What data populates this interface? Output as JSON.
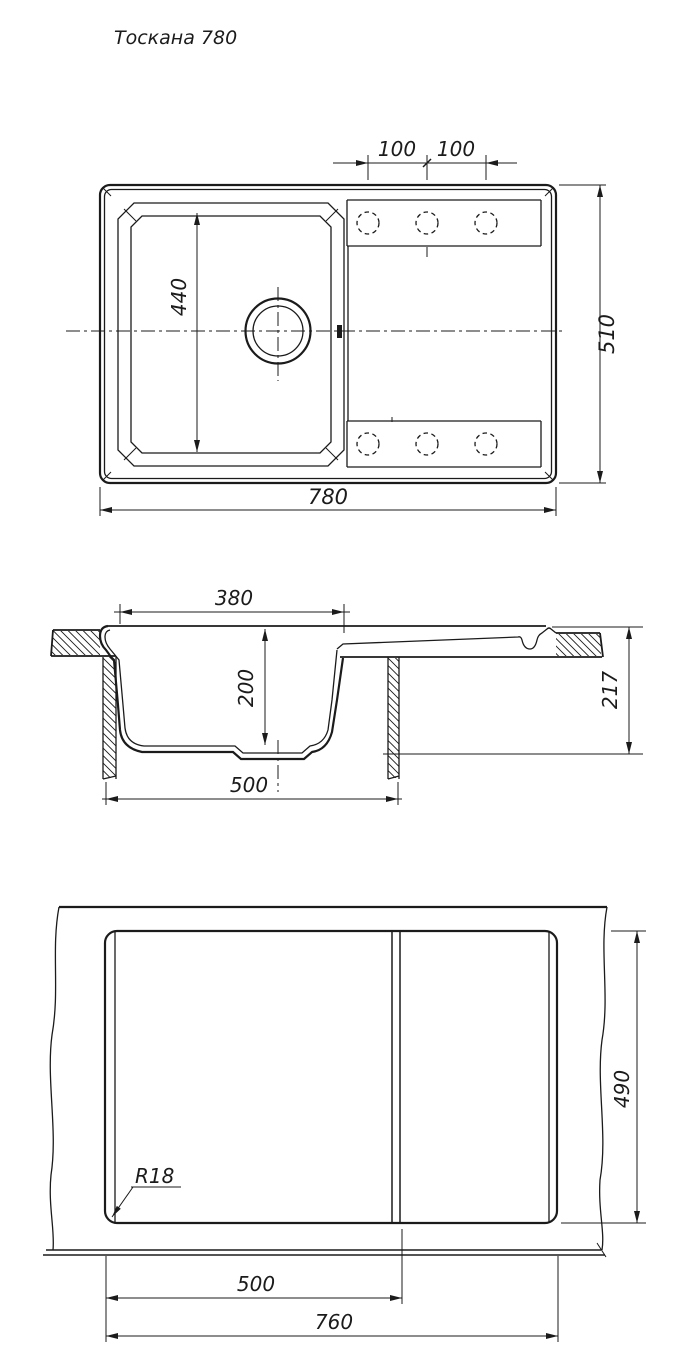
{
  "title": "Тоскана 780",
  "colors": {
    "line": "#1b1b1b",
    "background": "#ffffff"
  },
  "top_view": {
    "dim_hole_spacing_left": "100",
    "dim_hole_spacing_right": "100",
    "dim_bowl_length": "440",
    "dim_overall_width": "780",
    "dim_overall_depth": "510"
  },
  "section_view": {
    "dim_bowl_opening": "380",
    "dim_bowl_depth": "200",
    "dim_base_width": "500",
    "dim_overall_height": "217"
  },
  "cutout_view": {
    "dim_corner_radius": "R18",
    "dim_bowl_cutout": "500",
    "dim_cutout_width": "760",
    "dim_cutout_height": "490"
  }
}
